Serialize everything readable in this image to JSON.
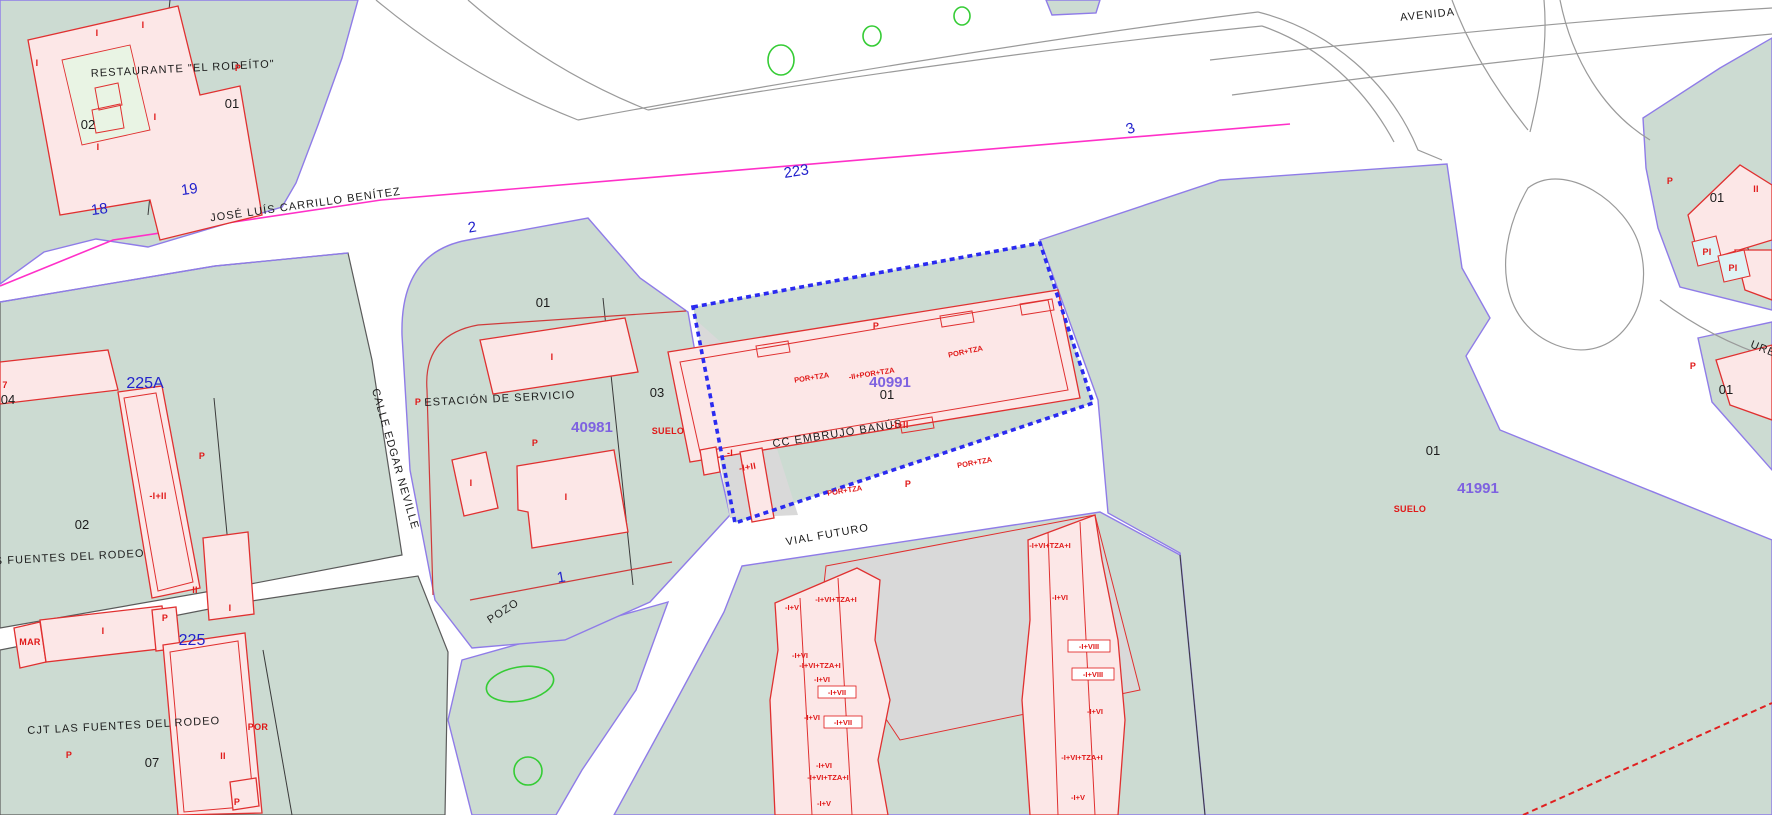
{
  "labels": {
    "restaurant": "RESTAURANTE \"EL RODEÍTO\"",
    "street_jlcb": "JOSÉ LUÍS CARRILLO BENÍTEZ",
    "street_avenida": "AVENIDA",
    "street_edgar": "CALLE EDGAR NEVILLE",
    "street_vial": "VIAL FUTURO",
    "street_urb": "URB",
    "pozo": "POZO",
    "estacion": "ESTACIÓN DE SERVICIO",
    "cc_embrujo": "CC EMBRUJO BANÚS",
    "fuentes": "LAS FUENTES DEL RODEO",
    "cjt": "CJT LAS FUENTES DEL RODEO",
    "suelo": "SUELO",
    "n01": "01",
    "n02": "02",
    "n03": "03",
    "n04": "04",
    "n07": "07",
    "ref40981": "40981",
    "ref40991": "40991",
    "ref41991": "41991",
    "sn18": "18",
    "sn19": "19",
    "sn2": "2",
    "sn223": "223",
    "sn3": "3",
    "sn1": "1",
    "sn225a": "225A",
    "sn225": "225",
    "p": "P",
    "i": "I",
    "ii": "II",
    "pi": "PI",
    "mar": "MAR",
    "por": "POR",
    "n7": "7",
    "h_i": "-I",
    "h_i_ii": "-I+II",
    "portza": "POR+TZA",
    "portza2": "-II+POR+TZA",
    "t_iv": "-I+V",
    "t_ivi": "-I+VI",
    "t_ivii": "-I+VII",
    "t_iviii": "-I+VIII",
    "t_ivitza": "-I+VI+TZA+I"
  },
  "colors": {
    "parcel_green": "#ccdbd2",
    "building_pink": "#fce7e7",
    "building_red": "#e03030",
    "boundary_violet": "#8f7ce8",
    "selection_blue": "#2b2bf0",
    "property_magenta": "#ff30c8",
    "cadastral_purple": "#7e62e0",
    "street_number_blue": "#2222cc",
    "vegetation_green": "#35cc35",
    "unbuilt_gray": "#d9d9d9",
    "pool_cyan": "#dff2f4"
  }
}
